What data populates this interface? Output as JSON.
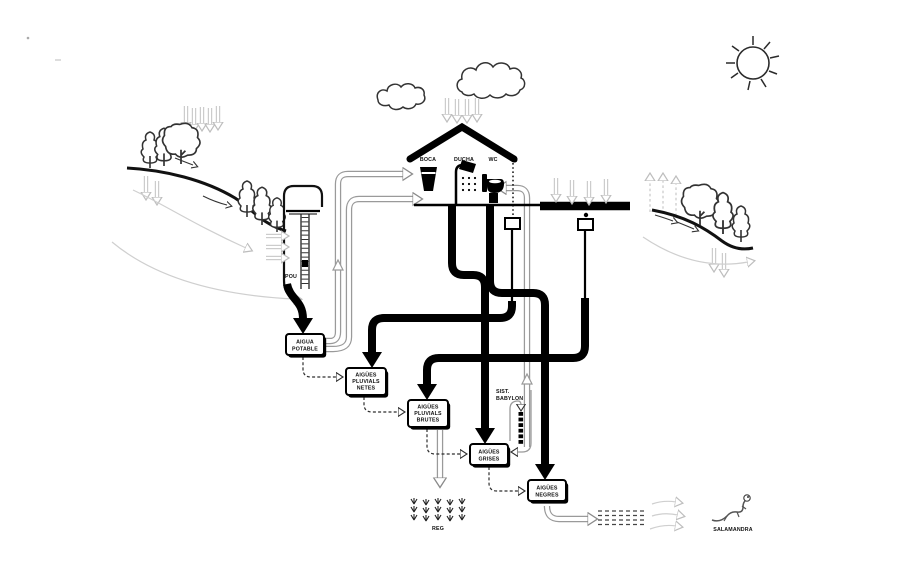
{
  "diagram": {
    "background": "#ffffff",
    "colors": {
      "ink": "#000000",
      "hollow_pipe_outline": "#9a9a9a",
      "rain_gray": "#c9c9c9",
      "paper": "#ffffff"
    },
    "labels": {
      "pou": "POU",
      "boca": "BOCA",
      "ducha": "DUCHA",
      "wc": "WC",
      "reg": "REG",
      "salamandra": "SALAMANDRA",
      "babylon_l1": "SIST.",
      "babylon_l2": "BABYLON"
    },
    "boxes": {
      "aigua_potable": {
        "l1": "AIGUA",
        "l2": "POTABLE"
      },
      "aigues_pluvials_netes": {
        "l1": "AIGÜES",
        "l2": "PLUVIALS",
        "l3": "NETES"
      },
      "aigues_pluvials_brutes": {
        "l1": "AIGÜES",
        "l2": "PLUVIALS",
        "l3": "BRUTES"
      },
      "aigues_grises": {
        "l1": "AIGÜES",
        "l2": "GRISES"
      },
      "aigues_negres": {
        "l1": "AIGÜES",
        "l2": "NEGRES"
      }
    },
    "icons": [
      "sun-icon",
      "cloud-icon",
      "rain-arrow-icon",
      "tree-icon",
      "well-icon",
      "cup-icon",
      "shower-icon",
      "toilet-icon",
      "pitched-roof-icon",
      "flat-roof-icon",
      "collector-box-icon",
      "irrigation-plants-icon",
      "infiltration-dashes-icon",
      "salamander-icon"
    ]
  }
}
